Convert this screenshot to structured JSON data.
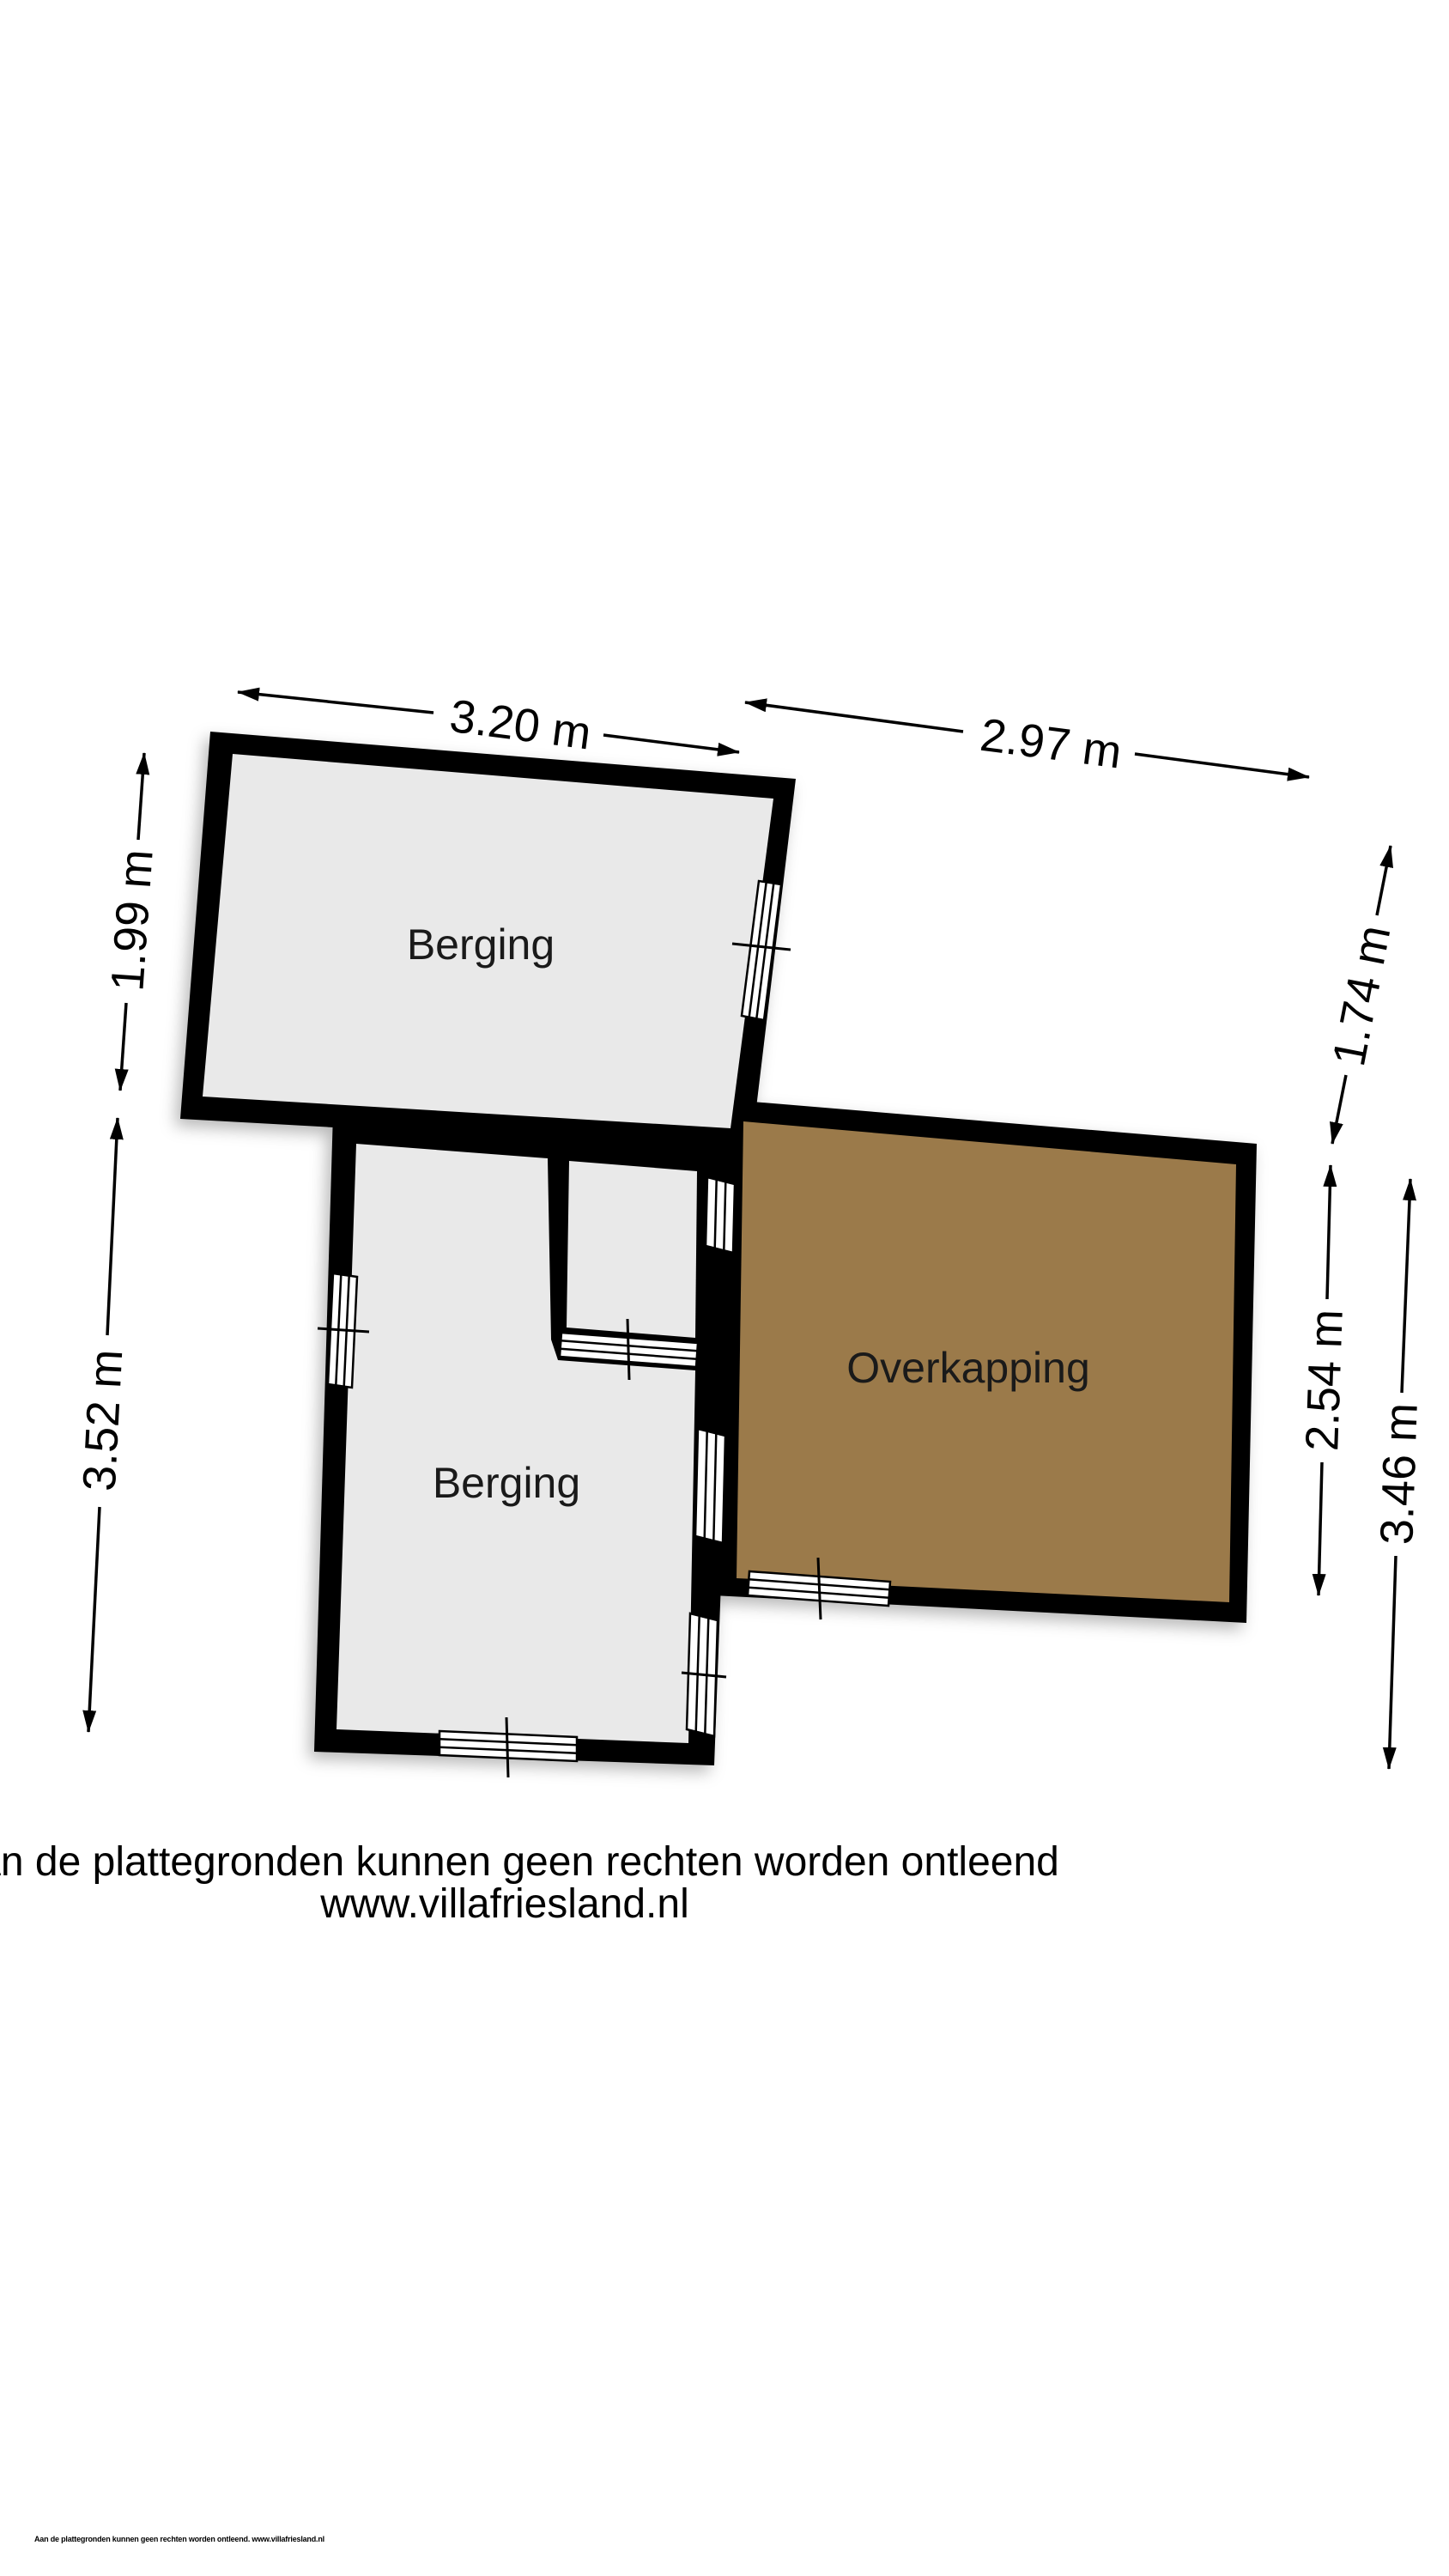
{
  "colors": {
    "wall": "#000000",
    "floor": "#e9e9e9",
    "overkapping_floor": "#9b7a4a",
    "background": "#ffffff"
  },
  "rooms": [
    {
      "name": "Berging"
    },
    {
      "name": "Berging"
    },
    {
      "name": "Overkapping"
    }
  ],
  "dimensions": {
    "top_left_width": "3.20 m",
    "top_right_width": "2.97 m",
    "left_upper_height": "1.99 m",
    "left_lower_height": "3.52 m",
    "right_upper_height": "1.74 m",
    "right_middle_height": "2.54 m",
    "right_lower_height": "3.46 m"
  },
  "disclaimer": {
    "line1": "Aan de plattegronden kunnen geen rechten worden ontleend",
    "line2": "www.villafriesland.nl"
  },
  "fine_print": "Aan de plattegronden kunnen geen rechten worden ontleend. www.villafriesland.nl"
}
